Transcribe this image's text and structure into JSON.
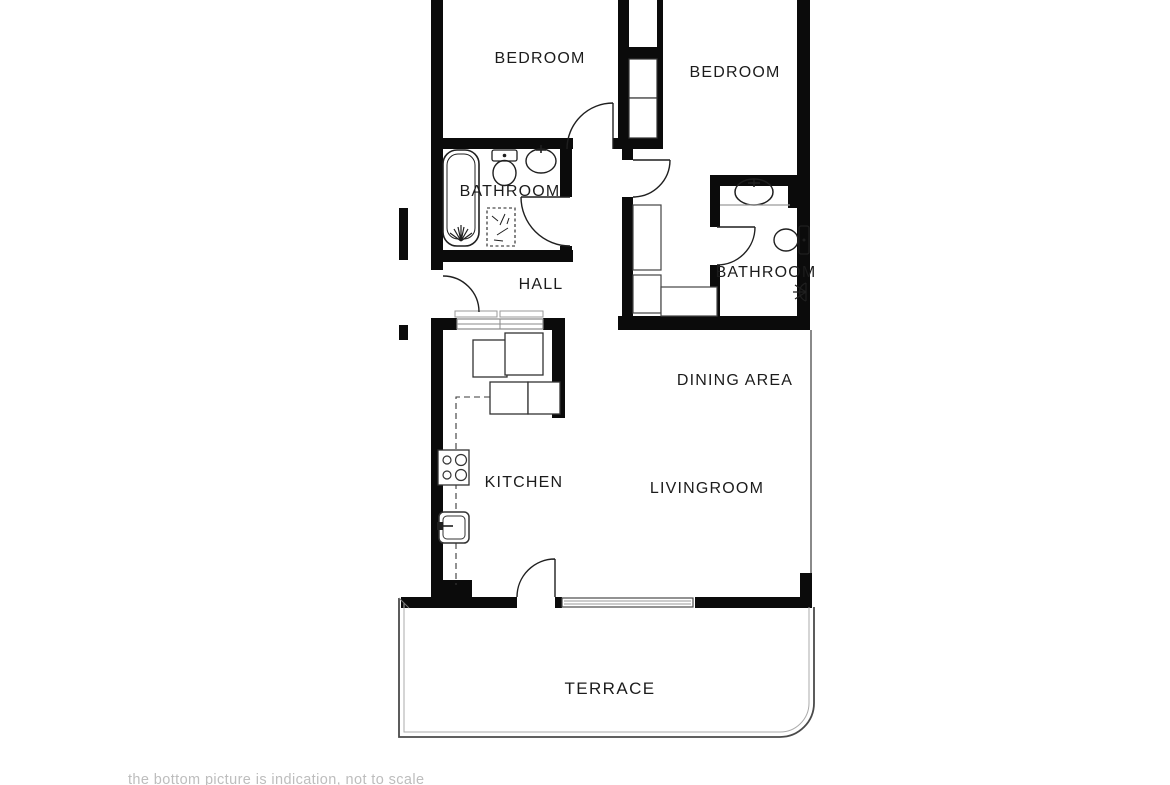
{
  "page": {
    "background": "#ffffff",
    "caption": "the bottom picture is indication, not to scale"
  },
  "floor_plan": {
    "rooms": {
      "bedroom_left": "BEDROOM",
      "bedroom_right": "BEDROOM",
      "bathroom_main": "BATHROOM",
      "hall": "HALL",
      "bathroom_second": "BATHROOM",
      "dining_area": "DINING AREA",
      "kitchen": "KITCHEN",
      "living_room": "LIVINGROOM",
      "terrace": "TERRACE"
    },
    "colors": {
      "wall": "#0b0b0b",
      "fixture_line": "#1f1f1f",
      "thin_line": "#9a9a9a",
      "caption_text": "#bdbdbd"
    },
    "fixtures": [
      "bathtub-icon",
      "toilet-icon",
      "wash-basin-icon",
      "bath-mat-icon",
      "shower-head-icon",
      "wardrobe-shelves",
      "closet-shelves",
      "stove-icon",
      "kitchen-sink-icon",
      "kitchen-counter",
      "window",
      "sliding-window",
      "door-swing"
    ]
  }
}
